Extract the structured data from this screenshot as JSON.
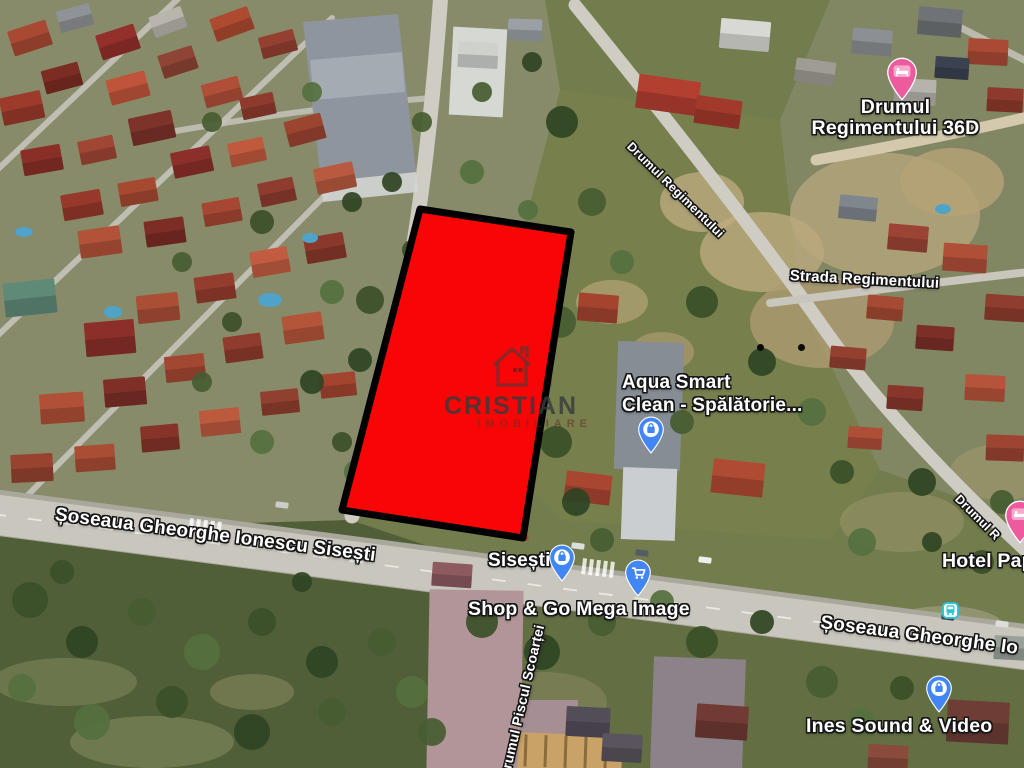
{
  "watermark": {
    "brand": "CRISTIAN",
    "subtitle": "IMOBILIARE",
    "icon": "house-outline-icon"
  },
  "plot": {
    "points": "420,209 571,232 523,538 342,510",
    "fill": "#f80505",
    "border": "#000000"
  },
  "labels": {
    "drumul_regimentului_36d": "Drumul\nRegimentului 36D",
    "strada_regimentului": "Strada Regimentului",
    "drumul_regimentului_road": "Drumul Regimentului",
    "aqua_smart": "Aqua Smart\nClean - Spălătorie...",
    "soseaua_gheorghe_ionescu_sisesti": "Șoseaua Gheorghe Ionescu Sisești",
    "sisesti_stop": "Sisești",
    "shop_and_go_mega_image": "Shop & Go Mega Image",
    "soseaua_gheorghe_right": "Șoseaua Gheorghe Io",
    "hotel_pap": "Hotel Pap",
    "ines_sound_video": "Ines Sound & Video",
    "drumul_right_edge": "Drumul R",
    "drumul_piscul_scoartei": "Drumul Piscul Scoarței"
  },
  "pins": {
    "lodging_pin_36d": {
      "icon": "bed-icon",
      "color": "#ee5a9e"
    },
    "lodging_pin_right_edge": {
      "icon": "bed-icon",
      "color": "#ee5a9e"
    },
    "aqua_smart_pin": {
      "icon": "shopping-bag-icon",
      "color": "#4285f4"
    },
    "sisesti_pin": {
      "icon": "shopping-bag-icon",
      "color": "#4285f4"
    },
    "mega_image_cart_pin": {
      "icon": "shopping-cart-icon",
      "color": "#4285f4"
    },
    "ines_pin": {
      "icon": "shopping-bag-icon",
      "color": "#4285f4"
    },
    "bus_stop": {
      "icon": "bus-icon",
      "color": "#2cc4d7"
    }
  },
  "colors": {
    "plot_red": "#f80505",
    "plot_border": "#000000",
    "poi_pin_blue": "#4285f4",
    "lodging_pin_pink": "#ee5a9e",
    "transit_teal": "#2cc4d7",
    "label_text": "#ffffff"
  }
}
